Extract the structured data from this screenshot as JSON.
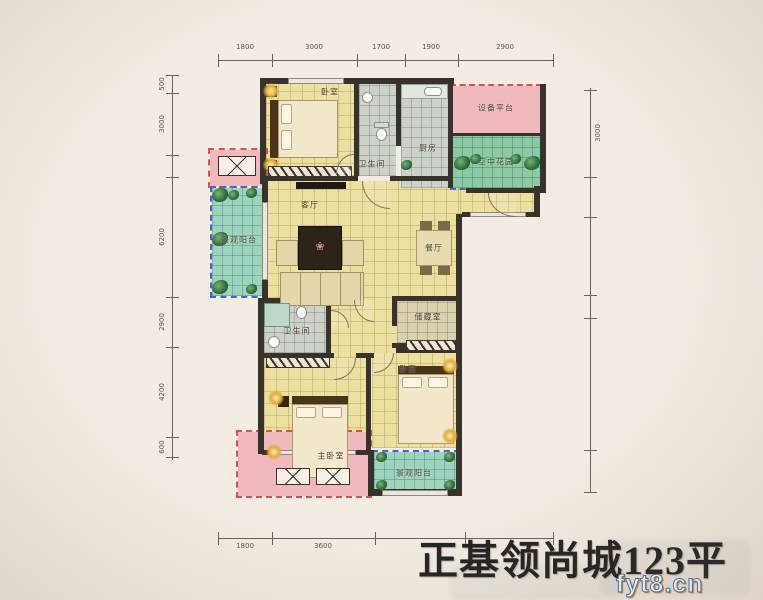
{
  "title": "正基领尚城123平",
  "watermark": "fyt8.cn",
  "rooms": {
    "bedroom_top": "卧室",
    "bath_top": "卫生间",
    "kitchen": "厨房",
    "equipment_platform": "设备平台",
    "sky_garden": "空中花园",
    "balcony_left": "景观阳台",
    "living": "客厅",
    "dining": "餐厅",
    "bath_mid": "卫生间",
    "storage": "储藏室",
    "master_bedroom": "主卧室",
    "bedroom_bottom": "卧室",
    "balcony_bottom": "景观阳台"
  },
  "dims": {
    "top": [
      "1800",
      "3000",
      "1700",
      "1900",
      "2900"
    ],
    "bottom": [
      "1800",
      "3600"
    ],
    "left": [
      "500",
      "3000",
      "6200",
      "2900",
      "4200",
      "600"
    ],
    "right": [
      "3000"
    ]
  },
  "colors": {
    "wall": "#37322b",
    "floor_yellow": "#ecdf9f",
    "floor_gray": "#ccd2c9",
    "balcony_green": "#9ed3bd",
    "platform_pink": "#f0b9bd",
    "dashed_red": "#d65050",
    "dashed_blue": "#4466cc",
    "background": "#f2ece2"
  }
}
